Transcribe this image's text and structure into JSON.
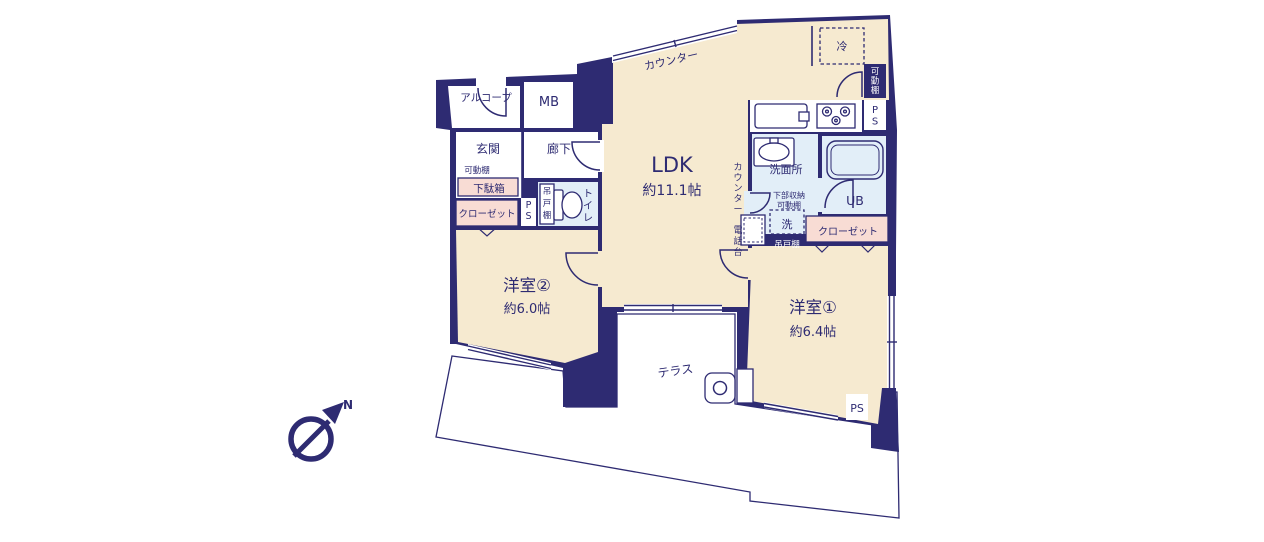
{
  "colors": {
    "wall": "#2e2b72",
    "room": "#f6ead0",
    "wet": "#e2eef8",
    "storage": "#f8dcd4",
    "paper": "#ffffff"
  },
  "rooms": {
    "ldk": {
      "name": "LDK",
      "area": "約11.1帖"
    },
    "bedroom1": {
      "name": "洋室①",
      "area": "約6.4帖"
    },
    "bedroom2": {
      "name": "洋室②",
      "area": "約6.0帖"
    },
    "entrance": {
      "name": "玄関"
    },
    "hallway": {
      "name": "廊下"
    },
    "toilet": {
      "name": "トイレ"
    },
    "washroom": {
      "name": "洗面所"
    },
    "bathroom": {
      "name": "UB"
    },
    "terrace": {
      "name": "テラス"
    },
    "alcove": {
      "name": "アルコープ"
    },
    "meter_box": {
      "name": "MB"
    }
  },
  "fixtures": {
    "counter_kitchen": "カウンター",
    "counter_hall": "カウンター",
    "phone_stand": "電話台",
    "refrigerator": "冷",
    "shoe_box": "下駄箱",
    "movable_shelf_entrance": "可動棚",
    "movable_shelf_kitchen": "可動棚",
    "movable_shelf_washroom": "可動棚",
    "lower_storage": "下部収納",
    "washing_machine": "洗",
    "hanging_cupboard_toilet": "吊戸棚",
    "hanging_cupboard_washroom": "吊戸棚",
    "closet_entrance": "クローゼット",
    "closet_bedroom1": "クローゼット",
    "ps_hallway": "PS",
    "ps_kitchen": "PS",
    "ps_bedroom1": "PS"
  },
  "compass": {
    "north": "N"
  }
}
